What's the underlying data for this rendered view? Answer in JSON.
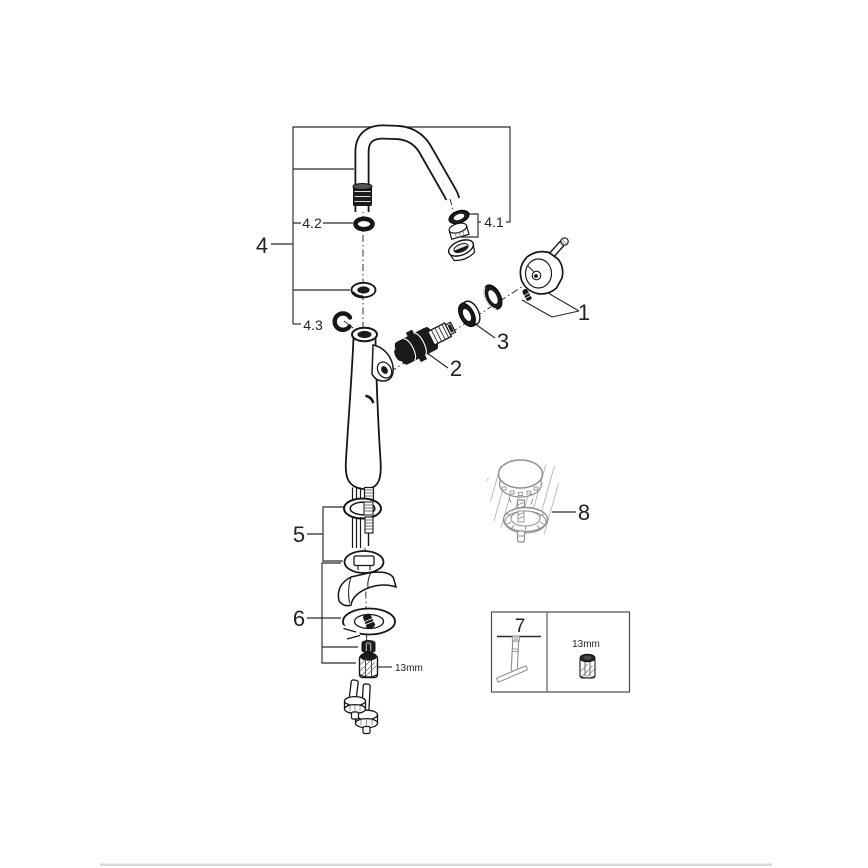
{
  "colors": {
    "background": "#ffffff",
    "line": "#1a1a1a",
    "secondary_line": "#8f8f8f",
    "hatch": "#b3b3b3",
    "footer_bar": "#d9d9d9"
  },
  "labels": {
    "part1": "1",
    "part2": "2",
    "part3": "3",
    "part4": "4",
    "part4_1": "4.1",
    "part4_2": "4.2",
    "part4_3": "4.3",
    "part5": "5",
    "part6": "6",
    "part7": "7",
    "part8": "8"
  },
  "annotations": {
    "mounting_nut_size": "13mm",
    "tool_socket_size": "13mm"
  }
}
